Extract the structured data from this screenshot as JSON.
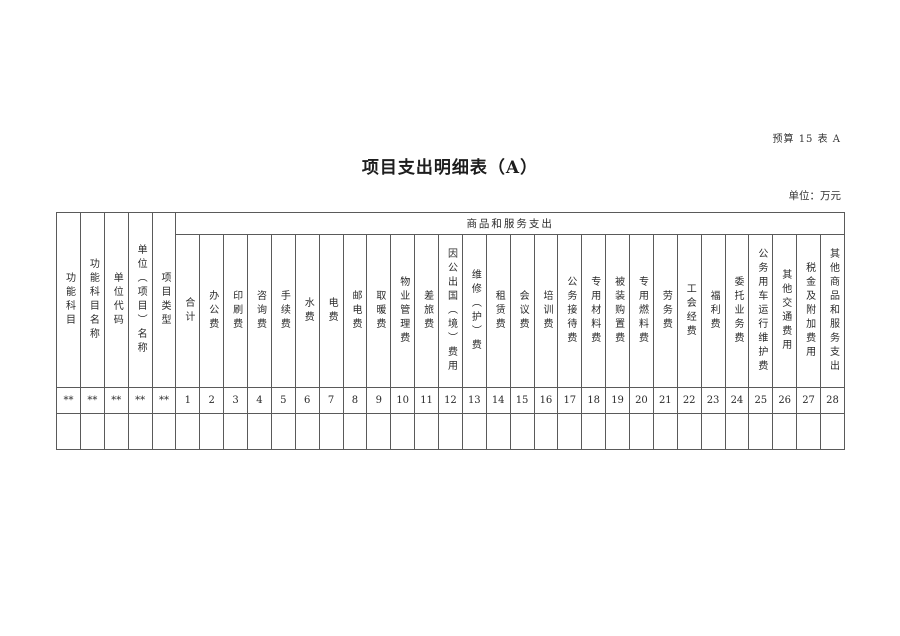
{
  "page": {
    "doc_ref": "预算 15 表 A",
    "title": "项目支出明细表（A）",
    "unit_note": "单位：万元"
  },
  "table": {
    "group_header": "商品和服务支出",
    "fixed_columns": [
      {
        "label": "功能科目",
        "code": "**"
      },
      {
        "label": "功能科目名称",
        "code": "**"
      },
      {
        "label": "单位代码",
        "code": "**"
      },
      {
        "label": "单位（项目）名称",
        "code": "**"
      },
      {
        "label": "项目类型",
        "code": "**"
      }
    ],
    "expense_columns": [
      {
        "label": "合计",
        "code": "1"
      },
      {
        "label": "办公费",
        "code": "2"
      },
      {
        "label": "印刷费",
        "code": "3"
      },
      {
        "label": "咨询费",
        "code": "4"
      },
      {
        "label": "手续费",
        "code": "5"
      },
      {
        "label": "水费",
        "code": "6"
      },
      {
        "label": "电费",
        "code": "7"
      },
      {
        "label": "邮电费",
        "code": "8"
      },
      {
        "label": "取暖费",
        "code": "9"
      },
      {
        "label": "物业管理费",
        "code": "10"
      },
      {
        "label": "差旅费",
        "code": "11"
      },
      {
        "label": "因公出国（境）费用",
        "code": "12"
      },
      {
        "label": "维修（护）费",
        "code": "13"
      },
      {
        "label": "租赁费",
        "code": "14"
      },
      {
        "label": "会议费",
        "code": "15"
      },
      {
        "label": "培训费",
        "code": "16"
      },
      {
        "label": "公务接待费",
        "code": "17"
      },
      {
        "label": "专用材料费",
        "code": "18"
      },
      {
        "label": "被装购置费",
        "code": "19"
      },
      {
        "label": "专用燃料费",
        "code": "20"
      },
      {
        "label": "劳务费",
        "code": "21"
      },
      {
        "label": "工会经费",
        "code": "22"
      },
      {
        "label": "福利费",
        "code": "23"
      },
      {
        "label": "委托业务费",
        "code": "24"
      },
      {
        "label": "公务用车运行维护费",
        "code": "25"
      },
      {
        "label": "其他交通费用",
        "code": "26"
      },
      {
        "label": "税金及附加费用",
        "code": "27"
      },
      {
        "label": "其他商品和服务支出",
        "code": "28"
      }
    ]
  }
}
